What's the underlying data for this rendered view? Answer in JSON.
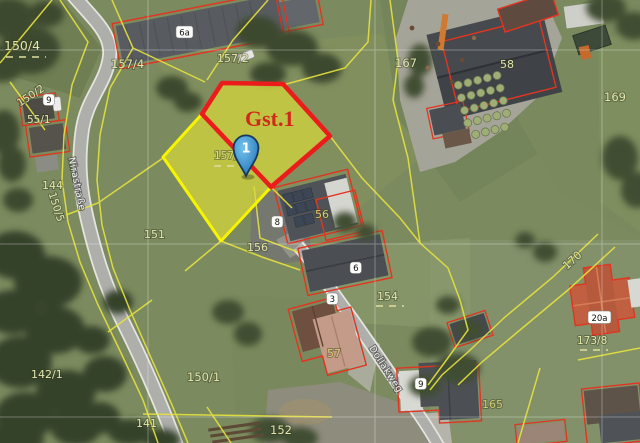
{
  "app": {
    "type": "aerial-cadastral-map-view"
  },
  "highlight": {
    "parcel_label": "Gst.1",
    "marker_number": "1",
    "parcel_number_under_marker": "157/1",
    "fill_color": "#d8d83a",
    "outline_red": "#ea1c1c",
    "outline_yellow": "#f8f400",
    "label_color": "#d0281a",
    "marker_color": "#3388cc"
  },
  "streets": {
    "nirastrasse": "Nirastraße",
    "dollakweg": "Dollakweg"
  },
  "parcels": {
    "p150_4": "150/4",
    "p157_4": "157/4",
    "p157_2": "157/2",
    "p150_2": "150/2",
    "p55_1": "55/1",
    "p150_5": "150/5",
    "p144": "144",
    "p151": "151",
    "p156": "156",
    "p56": "56",
    "p154": "154",
    "p57": "57",
    "p167": "167",
    "p58": "58",
    "p169": "169",
    "p170": "170",
    "p165": "165",
    "p173_8": "173/8",
    "p142_1": "142/1",
    "p150_1": "150/1",
    "p141": "141",
    "p152": "152"
  },
  "house_numbers": {
    "h6a": "6a",
    "h9_upper": "9",
    "h8": "8",
    "h6": "6",
    "h3": "3",
    "h9_lower": "9",
    "h20a": "20a"
  },
  "map_colors": {
    "boundary_line": "#e6e23f",
    "building_outline": "#e23420",
    "road_fill": "#aeaeab",
    "road_edge": "#e4e4e0",
    "grass_base": "#7c8b5f",
    "parcel_label_color": "#e3e5ad",
    "street_label_color": "#f4f4f0"
  }
}
